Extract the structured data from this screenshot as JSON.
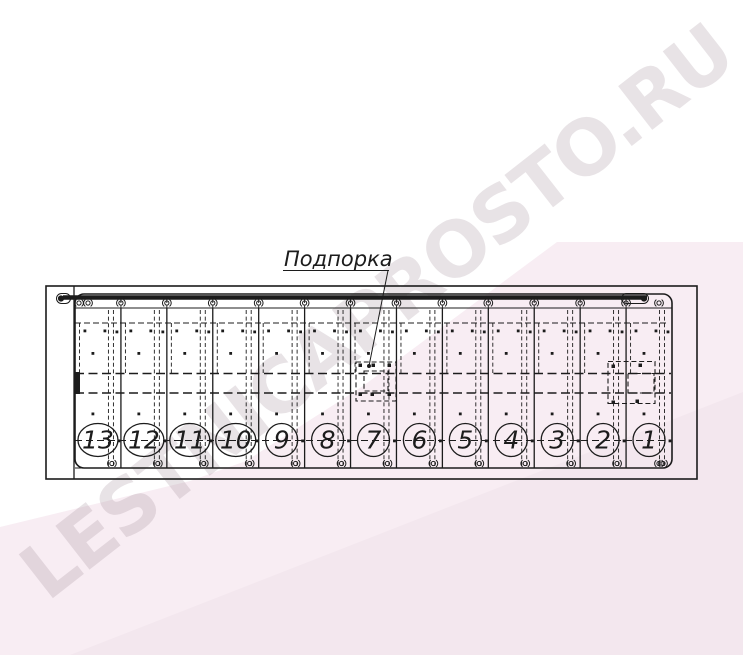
{
  "watermark": {
    "text": "LESTNICAPROSTO.RU"
  },
  "drawing": {
    "type": "staircase-plan-technical-drawing",
    "callout_label": "Подпорка",
    "step_count": 13,
    "steps": [
      "13",
      "12",
      "11",
      "10",
      "9",
      "8",
      "7",
      "6",
      "5",
      "4",
      "3",
      "2",
      "1"
    ]
  },
  "colors": {
    "line-color": "#1c1c1c",
    "pink-base": "#f8edf3",
    "pink-dark": "#f3e7ee",
    "watermark-color": "rgba(150,127,142,0.22)"
  }
}
